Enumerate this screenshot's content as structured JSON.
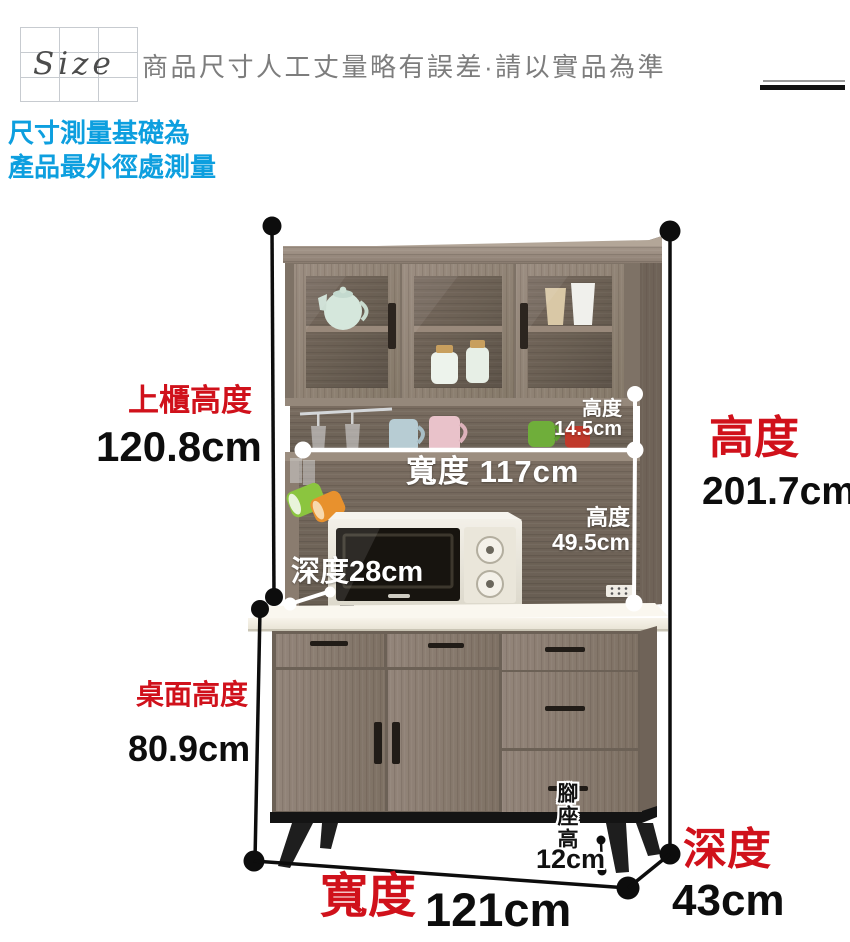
{
  "header": {
    "logo_text": "Size",
    "notice": "商品尺寸人工丈量略有誤差·請以實品為準"
  },
  "measure_note": {
    "line1": "尺寸測量基礎為",
    "line2": "產品最外徑處測量"
  },
  "dimensions": {
    "upper_cabinet_height": {
      "label": "上櫃高度",
      "value": "120.8cm"
    },
    "total_height": {
      "label": "高度",
      "value": "201.7cm"
    },
    "shelf_height": {
      "label": "高度",
      "value": "14.5cm"
    },
    "inner_width": {
      "label": "寬度 117cm"
    },
    "open_section_height": {
      "label": "高度",
      "value": "49.5cm"
    },
    "inner_depth": {
      "label": "深度28cm"
    },
    "counter_height": {
      "label": "桌面高度",
      "value": "80.9cm"
    },
    "leg_height": {
      "label": "腳座高",
      "value": "12cm"
    },
    "total_width": {
      "label": "寬度",
      "value": "121cm"
    },
    "total_depth": {
      "label": "深度",
      "value": "43cm"
    }
  },
  "colors": {
    "accent_red": "#d0111b",
    "note_blue": "#0d9fdf",
    "dimension_line_black": "#0d0d0d",
    "dimension_line_white": "#ffffff",
    "wood_main": "#8d7f74",
    "counter_white": "#f3efe5"
  }
}
